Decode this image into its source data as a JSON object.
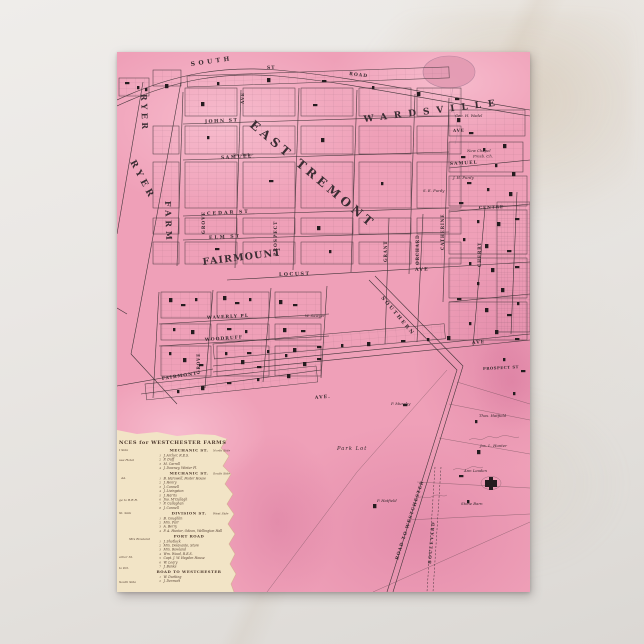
{
  "colors": {
    "postcard_pink": "#efa0b8",
    "pink_dark_blotch": "#e285a4",
    "pink_light": "#f6bdcd",
    "legend_cream": "#f2e4c6",
    "map_ink": "#43353a",
    "marble": "#e8e5e2"
  },
  "map": {
    "villages": [
      "EAST TREMONT",
      "WARDSVILLE",
      "FAIRMOUNT"
    ],
    "labels": [
      {
        "t": "EAST TREMONT",
        "x": 132,
        "y": 74,
        "r": 40,
        "s": 12,
        "ls": 4,
        "k": "big",
        "n": "map-label-east-tremont"
      },
      {
        "t": "WARDSVILLE",
        "x": 247,
        "y": 70,
        "r": -7,
        "s": 9,
        "ls": 7,
        "k": "big",
        "n": "map-label-wardsville"
      },
      {
        "t": "FAIRMOUNT",
        "x": 86,
        "y": 213,
        "r": -7,
        "s": 9.5,
        "ls": 1.2,
        "k": "big",
        "n": "map-label-fairmount"
      },
      {
        "t": "RYER",
        "x": 24,
        "y": 42,
        "r": 88,
        "s": 8,
        "ls": 3.4,
        "k": "big",
        "n": "map-label-ryer-farm"
      },
      {
        "t": "RYER",
        "x": 13,
        "y": 110,
        "r": 62,
        "s": 9,
        "ls": 4,
        "k": "big",
        "n": "map-label-ryer-farm"
      },
      {
        "t": "FARM",
        "x": 48,
        "y": 149,
        "r": 88,
        "s": 8,
        "ls": 4,
        "k": "big",
        "n": "map-label-ryer-farm"
      },
      {
        "t": "SOUTH",
        "x": 74,
        "y": 14,
        "r": -8,
        "s": 6,
        "ls": 3.5,
        "k": "street",
        "n": "map-street-south"
      },
      {
        "t": "ST",
        "x": 150,
        "y": 17,
        "r": -2,
        "s": 4.5,
        "ls": 1,
        "k": "street",
        "n": "map-street-south-st"
      },
      {
        "t": "ROAD",
        "x": 232,
        "y": 23,
        "r": 7,
        "s": 4.5,
        "ls": 1,
        "k": "street",
        "n": "map-street-road"
      },
      {
        "t": "JOHN ST",
        "x": 88,
        "y": 71,
        "r": -3,
        "s": 4.6,
        "ls": 1.5,
        "k": "street",
        "n": "map-street-john"
      },
      {
        "t": "SAMUEL",
        "x": 104,
        "y": 107,
        "r": -3,
        "s": 4.6,
        "ls": 1.5,
        "k": "street",
        "n": "map-street-samuel"
      },
      {
        "t": "CEDAR ST",
        "x": 90,
        "y": 163,
        "r": -3,
        "s": 4.6,
        "ls": 2,
        "k": "street",
        "n": "map-street-cedar"
      },
      {
        "t": "ELM ST",
        "x": 92,
        "y": 187,
        "r": -3,
        "s": 4.6,
        "ls": 2,
        "k": "street",
        "n": "map-street-elm"
      },
      {
        "t": "LOCUST",
        "x": 162,
        "y": 224,
        "r": -2,
        "s": 4.8,
        "ls": 1.5,
        "k": "street",
        "n": "map-street-locust"
      },
      {
        "t": "AVE",
        "x": 298,
        "y": 219,
        "r": -2,
        "s": 4.8,
        "ls": 1,
        "k": "street",
        "n": "map-street-locust-ave"
      },
      {
        "t": "SAMUEL",
        "x": 333,
        "y": 113,
        "r": -3,
        "s": 4.4,
        "ls": 1,
        "k": "street",
        "n": "map-street-samuel-east"
      },
      {
        "t": "CENTRE",
        "x": 362,
        "y": 157,
        "r": -2,
        "s": 4.2,
        "ls": 0.8,
        "k": "street",
        "n": "map-street-centre"
      },
      {
        "t": "AVE",
        "x": 336,
        "y": 80,
        "r": -2,
        "s": 4.2,
        "ls": 0.8,
        "k": "street",
        "n": "map-street-ave"
      },
      {
        "t": "WAVERLY PL",
        "x": 90,
        "y": 267,
        "r": -3,
        "s": 4.4,
        "ls": 1,
        "k": "street",
        "n": "map-street-waverly-pl"
      },
      {
        "t": "WOODRUFF",
        "x": 88,
        "y": 289,
        "r": -4,
        "s": 4.4,
        "ls": 1,
        "k": "street",
        "n": "map-street-woodruff"
      },
      {
        "t": "FAIRMONT",
        "x": 45,
        "y": 328,
        "r": -9,
        "s": 4.4,
        "ls": 1,
        "k": "street",
        "n": "map-street-fairmont"
      },
      {
        "t": "AVE",
        "x": 355,
        "y": 292,
        "r": -4,
        "s": 4.6,
        "ls": 1,
        "k": "street",
        "n": "map-street-ave-mid"
      },
      {
        "t": "AVE.",
        "x": 198,
        "y": 347,
        "r": -5,
        "s": 4.6,
        "ls": 1,
        "k": "street",
        "n": "map-street-ave-lower"
      },
      {
        "t": "PROSPECT ST",
        "x": 366,
        "y": 318,
        "r": -3,
        "s": 3.8,
        "ls": 0.5,
        "k": "street",
        "n": "map-street-prospect-st"
      },
      {
        "t": "SOUTHERN",
        "x": 264,
        "y": 246,
        "r": 50,
        "s": 5,
        "ls": 2,
        "k": "street",
        "n": "map-street-southern-blvd"
      },
      {
        "t": "ROAD TO WESTCHESTER",
        "x": 281,
        "y": 508,
        "r": -72,
        "s": 4.4,
        "ls": 1,
        "k": "street",
        "n": "map-street-road-to-westchester"
      },
      {
        "t": "BOULEVARD",
        "x": 314,
        "y": 512,
        "r": -85,
        "s": 4.2,
        "ls": 1.4,
        "k": "street",
        "n": "map-street-boulevard"
      },
      {
        "t": "GROVE",
        "x": 88,
        "y": 182,
        "r": -90,
        "s": 4.4,
        "ls": 1,
        "k": "vstreet",
        "n": "map-street-grove"
      },
      {
        "t": "PROSPECT",
        "x": 160,
        "y": 204,
        "r": -90,
        "s": 4.4,
        "ls": 1,
        "k": "vstreet",
        "n": "map-street-prospect"
      },
      {
        "t": "GROVE",
        "x": 83,
        "y": 322,
        "r": -90,
        "s": 4.2,
        "ls": 0.8,
        "k": "vstreet",
        "n": "map-street-grove-south"
      },
      {
        "t": "CATHERINE",
        "x": 327,
        "y": 198,
        "r": -90,
        "s": 4.2,
        "ls": 0.8,
        "k": "vstreet",
        "n": "map-street-catherine"
      },
      {
        "t": "ORCHARD",
        "x": 302,
        "y": 213,
        "r": -90,
        "s": 4.2,
        "ls": 0.8,
        "k": "vstreet",
        "n": "map-street-orchard"
      },
      {
        "t": "GRANT",
        "x": 270,
        "y": 210,
        "r": -90,
        "s": 4.2,
        "ls": 0.8,
        "k": "vstreet",
        "n": "map-street-grant"
      },
      {
        "t": "CHERRY",
        "x": 364,
        "y": 215,
        "r": -90,
        "s": 4.2,
        "ls": 0.8,
        "k": "vstreet",
        "n": "map-street-cherry"
      },
      {
        "t": "AVE",
        "x": 127,
        "y": 52,
        "r": -90,
        "s": 4.2,
        "ls": 0.8,
        "k": "vstreet",
        "n": "map-street-ave-vertical"
      },
      {
        "t": "Geo. H. Wadel",
        "x": 338,
        "y": 65,
        "s": 3.8,
        "k": "owner",
        "n": "map-owner-label"
      },
      {
        "t": "New Chapel",
        "x": 350,
        "y": 100,
        "s": 3.8,
        "k": "owner",
        "n": "map-owner-label"
      },
      {
        "t": "Presb. Ch.",
        "x": 356,
        "y": 105.5,
        "s": 3.8,
        "k": "owner",
        "n": "map-owner-label"
      },
      {
        "t": "J. H. Purdy",
        "x": 336,
        "y": 127,
        "s": 3.8,
        "k": "owner",
        "n": "map-owner-label"
      },
      {
        "t": "S. E. Purdy",
        "x": 306,
        "y": 140,
        "s": 3.8,
        "k": "owner",
        "n": "map-owner-label"
      },
      {
        "t": "Jas. Butler",
        "x": 116,
        "y": 104,
        "s": 3.8,
        "k": "owner",
        "n": "map-owner-label"
      },
      {
        "t": "W. Sawyer",
        "x": 188,
        "y": 265,
        "s": 3.8,
        "k": "owner",
        "n": "map-owner-label"
      },
      {
        "t": "P. Murphy",
        "x": 274,
        "y": 353,
        "s": 3.8,
        "k": "owner",
        "n": "map-owner-label"
      },
      {
        "t": "Thos. Hatfield",
        "x": 362,
        "y": 365,
        "s": 3.8,
        "k": "owner",
        "n": "map-owner-label"
      },
      {
        "t": "Jos. L. Hunter",
        "x": 363,
        "y": 395,
        "s": 3.8,
        "k": "owner",
        "n": "map-owner-label"
      },
      {
        "t": "Ann Leaden",
        "x": 347,
        "y": 420,
        "s": 3.8,
        "k": "owner",
        "n": "map-owner-label"
      },
      {
        "t": "Stone Barn",
        "x": 344,
        "y": 453,
        "s": 3.8,
        "k": "owner",
        "n": "map-owner-label"
      },
      {
        "t": "P. Hatfield",
        "x": 260,
        "y": 450,
        "s": 3.8,
        "k": "owner",
        "n": "map-owner-label"
      },
      {
        "t": "Park Lot",
        "x": 220,
        "y": 398,
        "s": 5.2,
        "ls": 1,
        "k": "owner",
        "n": "map-owner-park-lot"
      }
    ]
  },
  "legend": {
    "header": "NCES for WESTCHESTER FARMS",
    "sections": [
      {
        "title": "MECHANIC ST.",
        "side": "North Side",
        "entries": [
          "J. Archer, R.E.S.",
          "F. Duff",
          "M. Carroll",
          "J. Downey, Winter Pl."
        ]
      },
      {
        "title": "MECHANIC ST.",
        "side": "South Side",
        "entries": [
          "B. Harswell, Foster House",
          "J. Henry",
          "J. Connell",
          "J. Livingston",
          "J. Harris",
          "Jno. M'Cullagh",
          "F. Callaghan",
          "J. Connell"
        ]
      },
      {
        "title": "DIVISION ST.",
        "side": "West Side",
        "entries": [
          "B. Coughlin",
          "Mrs. Parr",
          "A. Berry",
          "P. A. Hunter, Odeon, Wellington Hall"
        ]
      },
      {
        "title": "PORT ROAD",
        "side": "",
        "entries": [
          "J. Shotlock",
          "Mrs. Delavante, Store",
          "Mrs. Rowland",
          "Wm. Wood, R.E.S.",
          "Capt. J. W. Hayden House",
          "W. Leary",
          "J. Banks"
        ]
      },
      {
        "title": "ROAD TO WESTCHESTER",
        "side": "",
        "entries": [
          "W. Durking",
          "J. Dermott"
        ]
      }
    ],
    "fragments": [
      {
        "t": "t Side",
        "x": 2,
        "y": 399
      },
      {
        "t": "use Hotel",
        "x": 2,
        "y": 409
      },
      {
        "t": "44.",
        "x": 4,
        "y": 427
      },
      {
        "t": "ge to B.R.R.",
        "x": 2,
        "y": 449
      },
      {
        "t": "St. Side",
        "x": 2,
        "y": 462
      },
      {
        "t": "Mrs Rowland",
        "x": 12,
        "y": 488
      },
      {
        "t": "arbor St.",
        "x": 2,
        "y": 506
      },
      {
        "t": "to P.O.",
        "x": 2,
        "y": 517
      },
      {
        "t": "South Side",
        "x": 2,
        "y": 531
      }
    ]
  }
}
